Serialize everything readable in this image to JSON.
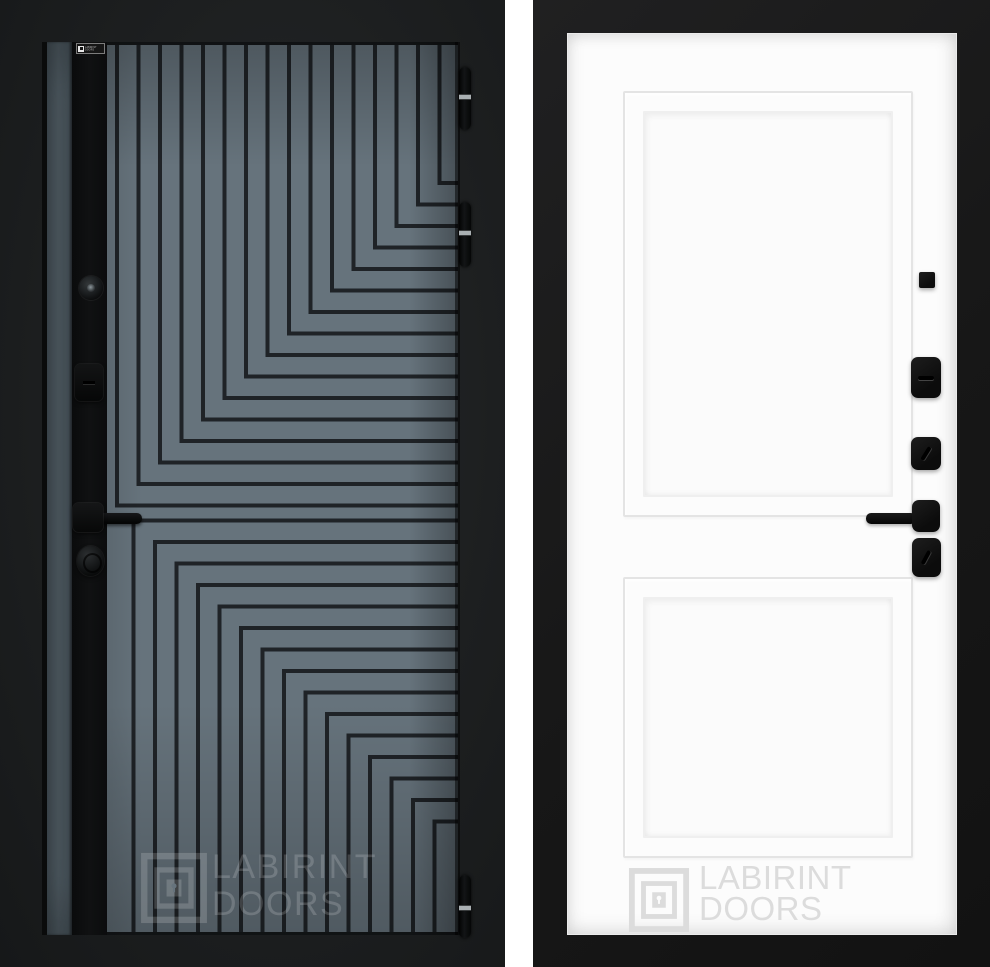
{
  "page": {
    "background_color": "#ffffff",
    "description": "Two product photos of a LABIRINT entrance door: exterior patterned side and interior white side"
  },
  "brand": {
    "line1": "LABIRINT",
    "line2": "DOORS"
  },
  "left_door": {
    "view": "exterior-side",
    "colors": {
      "backdrop": "#1d1f20",
      "panel_gray": "#66737c",
      "groove": "#1f2327",
      "lock_strip": "#0e0f10",
      "edge_gray": "#5e6c75",
      "hinge_band": "#aab0b3"
    },
    "brand_plate": {
      "line1": "LABIRINT",
      "line2": "DOORS"
    },
    "watermark": {
      "line1": "LABIRINT",
      "line2": "DOORS",
      "color": "rgba(255,255,255,0.17)"
    },
    "hinge_count": 3
  },
  "right_door": {
    "view": "interior-side",
    "colors": {
      "frame": "#171717",
      "leaf": "#fcfcfc",
      "panel_line": "#e4e4e4",
      "hardware": "#101010"
    },
    "watermark": {
      "line1": "LABIRINT",
      "line2": "DOORS",
      "color": "#dcdcdc"
    }
  },
  "pattern": {
    "step": 21.5,
    "upper_lines": 16,
    "lower_lines": 15
  }
}
